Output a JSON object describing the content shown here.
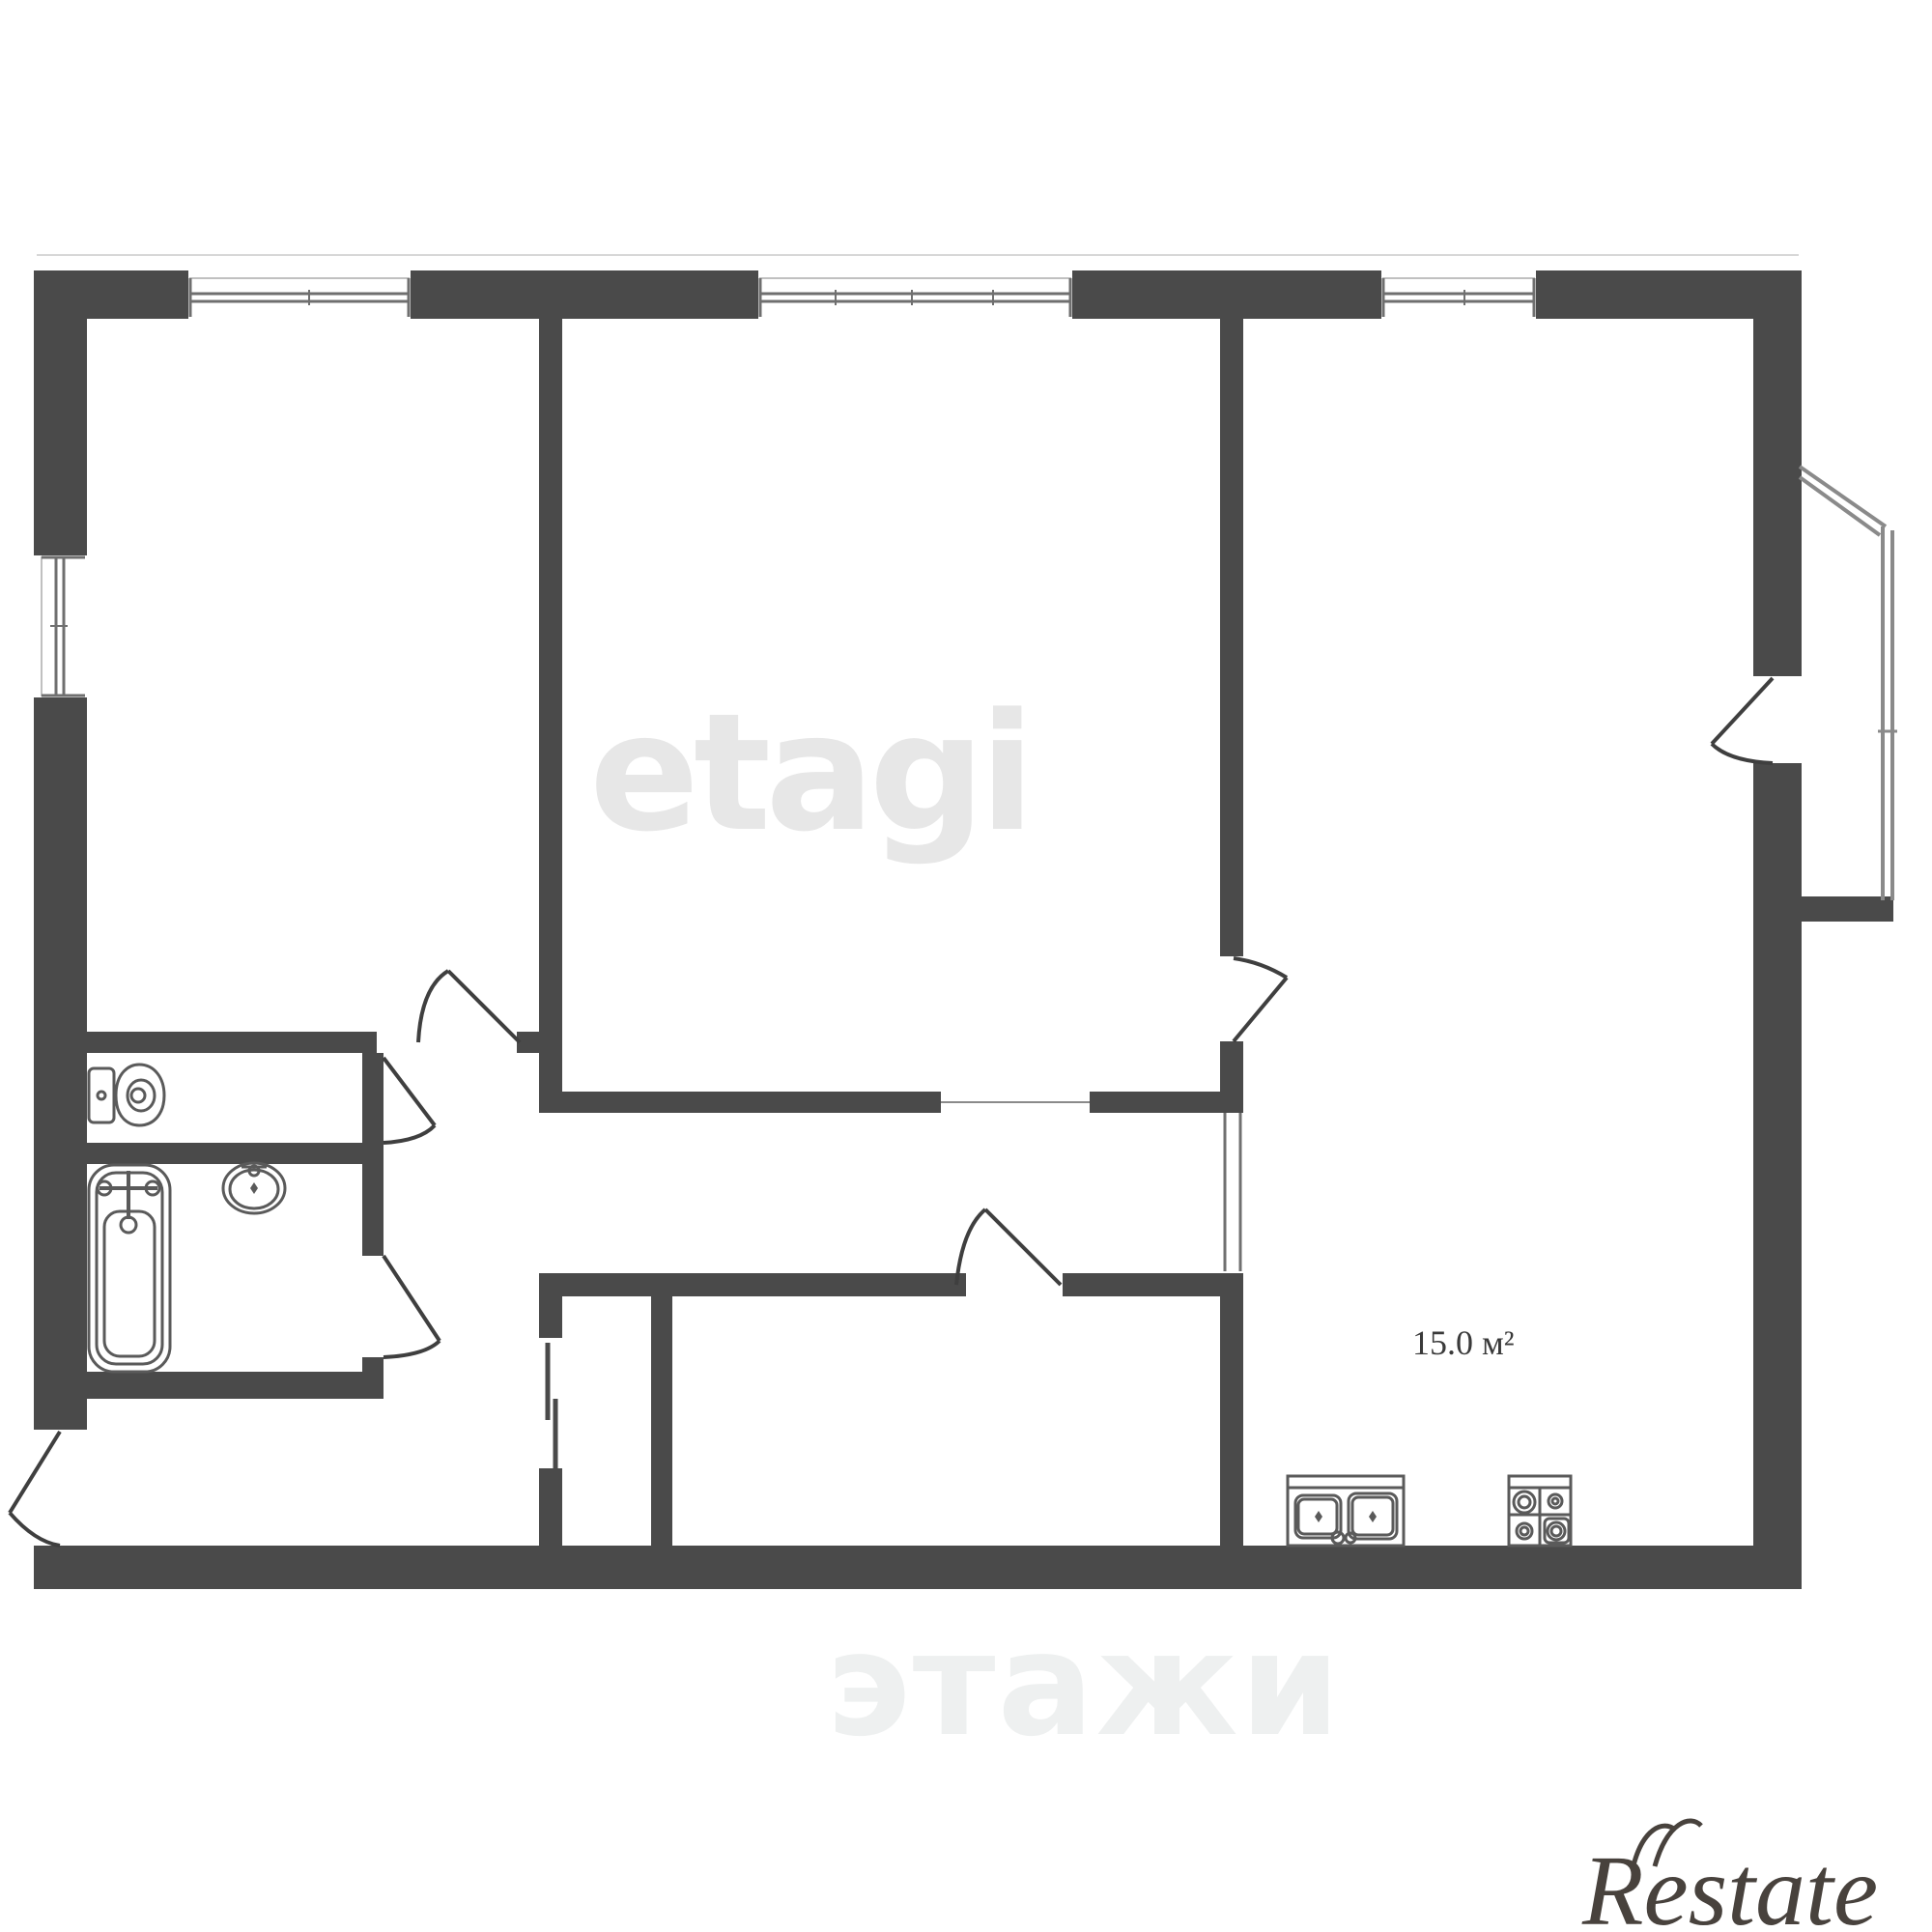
{
  "floor_plan": {
    "area_label": "15.0 м²",
    "watermark_center": "etagi",
    "watermark_bottom": "этажи",
    "brand_logo": "Restate",
    "colors": {
      "wall": "#4a4a4a",
      "door_line": "#3f3f3f",
      "window_line": "#6f6f6f",
      "window_outer_line": "#c9c9c9",
      "fixture_line": "#5a5a5a",
      "railing_line": "#8a8a8a",
      "watermark": "#e7e7e7",
      "ghost_watermark": "#eef0f0",
      "logo": "#48423d",
      "background": "#ffffff"
    },
    "icons": {
      "toilet": "toilet-icon",
      "bathtub": "bathtub-icon",
      "wash_sink": "wash-sink-icon",
      "kitchen_sink": "kitchen-sink-icon",
      "stove": "stove-icon",
      "windows": "window-icon",
      "doors": "door-arc-icon",
      "balcony": "balcony-railing-icon"
    }
  }
}
